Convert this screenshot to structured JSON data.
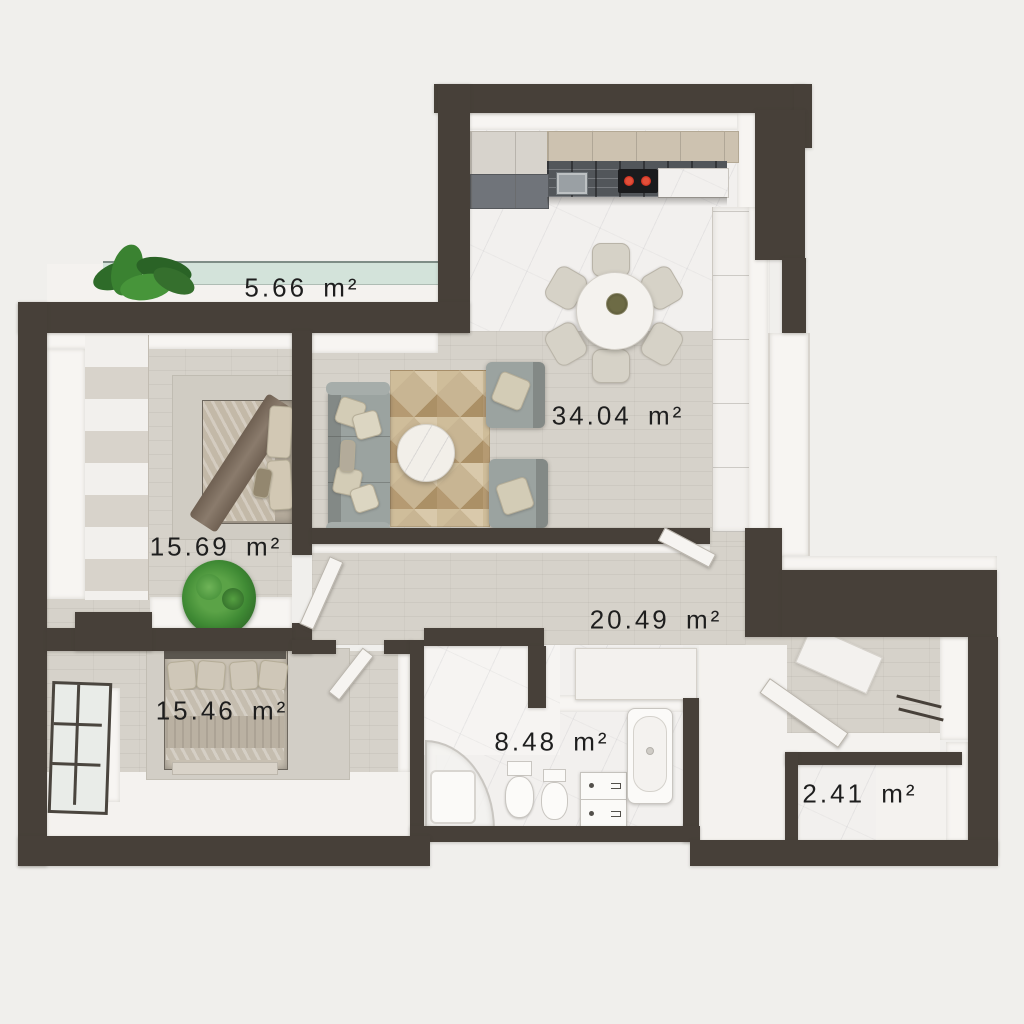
{
  "plan": {
    "type": "apartment-floor-plan-3d-top-view",
    "unit_suffix": "m²",
    "rooms": [
      {
        "id": "balcony",
        "area": "5.66",
        "label": "5.66 m²"
      },
      {
        "id": "living-kitchen",
        "area": "34.04",
        "label": "34.04 m²"
      },
      {
        "id": "bedroom-1",
        "area": "15.69",
        "label": "15.69 m²"
      },
      {
        "id": "hallway",
        "area": "20.49",
        "label": "20.49 m²"
      },
      {
        "id": "bedroom-2",
        "area": "15.46",
        "label": "15.46 m²"
      },
      {
        "id": "bathroom",
        "area": "8.48",
        "label": "8.48 m²"
      },
      {
        "id": "storage",
        "area": "2.41",
        "label": "2.41 m²"
      }
    ],
    "colors": {
      "wall": "#474039",
      "background": "#f0efec",
      "wood_floor": "#d6d2ca",
      "marble_floor": "#f2f0ee",
      "balcony_glass": "#cde0d6",
      "rug": "#c8b593",
      "sofa": "#9ba3a0",
      "plant_green": "#3f8a34",
      "cooktop_burner": "#cf2f1f",
      "label_text": "#1e1e1e"
    }
  }
}
